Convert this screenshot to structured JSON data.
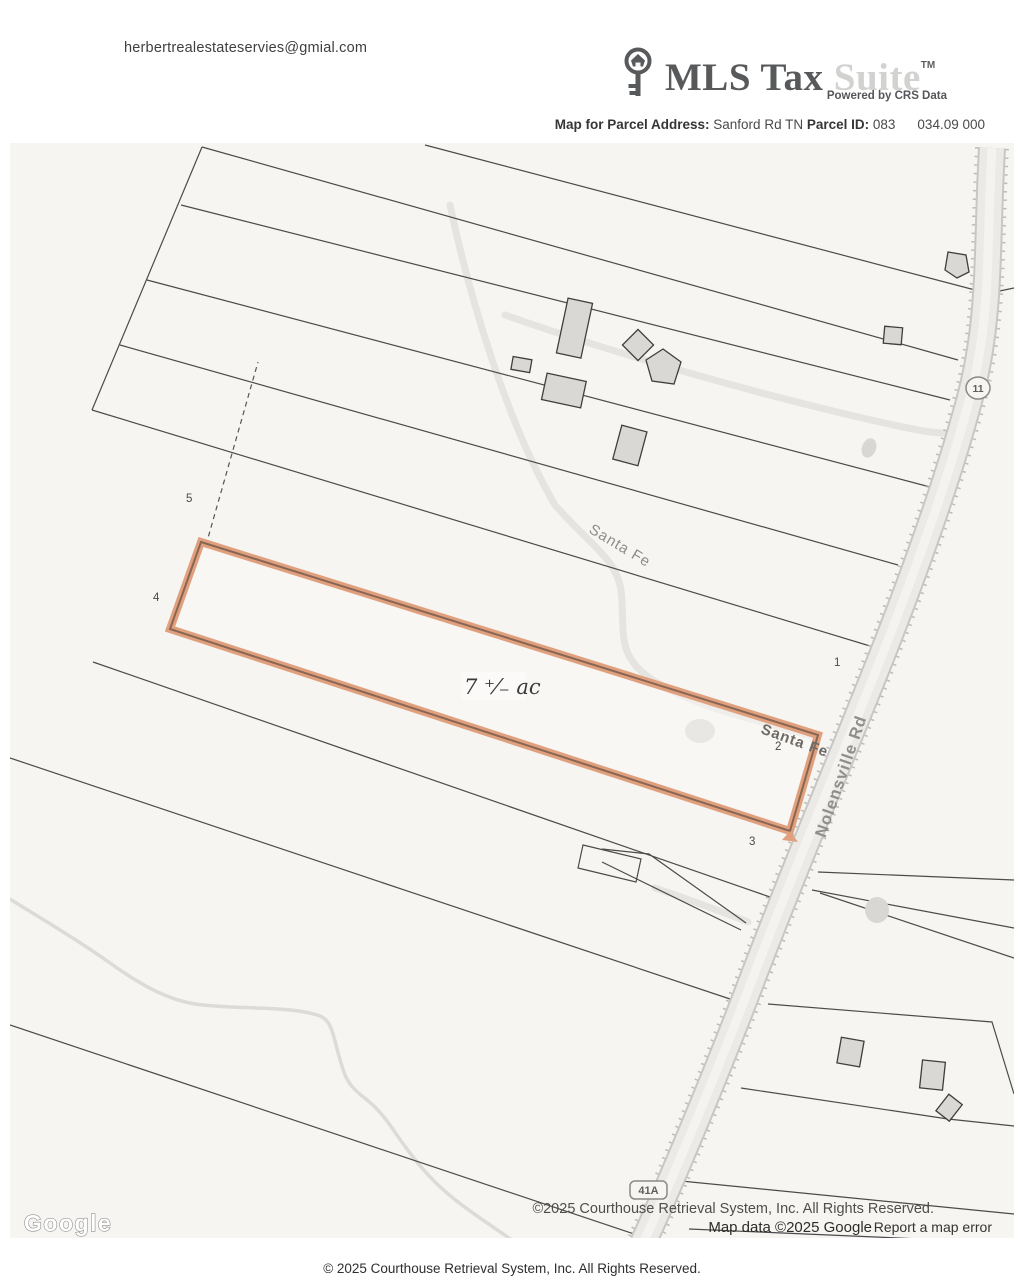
{
  "header": {
    "email": "herbertrealestateservies@gmial.com",
    "logo": {
      "brand_primary": "MLS Tax",
      "brand_secondary": "Suite",
      "trademark": "TM",
      "tagline": "Powered by CRS Data"
    },
    "subtitle": {
      "map_for_label": "Map for Parcel Address:",
      "address": "Sanford Rd TN",
      "parcel_id_label": "Parcel ID:",
      "parcel_id_book": "083",
      "parcel_id_number": "034.09 000"
    }
  },
  "map": {
    "road_labels": {
      "santa_fe_upper": "Santa Fe",
      "santa_fe_lower": "Santa Fe",
      "nolensville": "Nolensville Rd"
    },
    "route_shields": {
      "route_11": "11",
      "route_41a": "41A"
    },
    "acreage_annotation": "7 ⁺⁄₋ ac",
    "parcel_numbers": [
      "1",
      "2",
      "3",
      "4",
      "5"
    ],
    "google_logo": "Google",
    "attribution_line1": "©2025 Courthouse Retrieval System, Inc. All Rights Reserved.",
    "attribution_line2": "Map data ©2025 Google",
    "report_error": "Report a map error",
    "highlight_color": "#e0a07e"
  },
  "footer": {
    "copyright": "© 2025 Courthouse Retrieval System, Inc. All Rights Reserved."
  }
}
